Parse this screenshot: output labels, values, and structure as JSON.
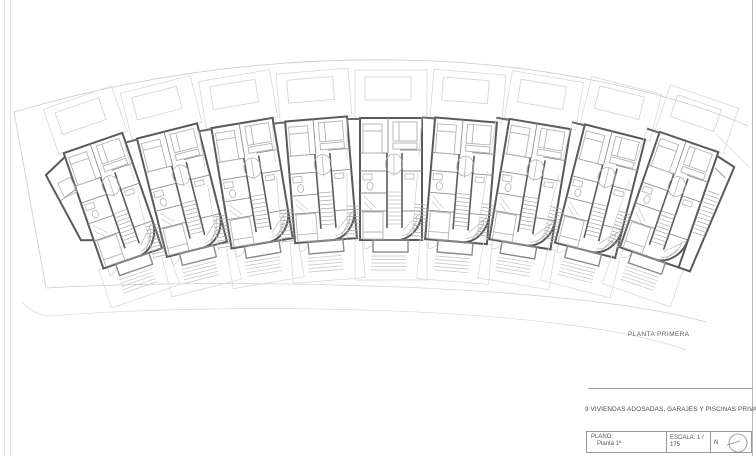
{
  "sheet": {
    "caption": "PLANTA PRIMERA"
  },
  "titleblock": {
    "project_title": "9 VIVIENDAS ADOSADAS, GARAJES Y PISCINAS PRIVADAS",
    "plano_label": "PLANO:",
    "plano_value": "Planta 1ª",
    "escala_label": "ESCALA: 1 / 175",
    "north_label": "N"
  },
  "plan": {
    "description": "Fan-shaped row of 9 townhouse floor plans with front yards above and rear gardens below",
    "unit_count": 9,
    "units": [
      {
        "id": 1,
        "x": 93,
        "y": 143,
        "angle": -19,
        "type": "left-end"
      },
      {
        "id": 2,
        "x": 167,
        "y": 131,
        "angle": -14.2,
        "type": "mid"
      },
      {
        "id": 3,
        "x": 242,
        "y": 123,
        "angle": -9.5,
        "type": "mid"
      },
      {
        "id": 4,
        "x": 316,
        "y": 119,
        "angle": -4.7,
        "type": "mid"
      },
      {
        "id": 5,
        "x": 391,
        "y": 118,
        "angle": 0,
        "type": "mid"
      },
      {
        "id": 6,
        "x": 466,
        "y": 120,
        "angle": 4.7,
        "type": "mid"
      },
      {
        "id": 7,
        "x": 540,
        "y": 124,
        "angle": 9.5,
        "type": "mid"
      },
      {
        "id": 8,
        "x": 615,
        "y": 132,
        "angle": 14.2,
        "type": "mid"
      },
      {
        "id": 9,
        "x": 689,
        "y": 142,
        "angle": 19,
        "type": "right-end"
      }
    ],
    "colors": {
      "wall_dark": "#5a5a5a",
      "partition": "#8f8f8f",
      "furniture": "#b3b3b3",
      "yard_line": "#d8d8d8",
      "boundary": "#cccccc"
    }
  }
}
